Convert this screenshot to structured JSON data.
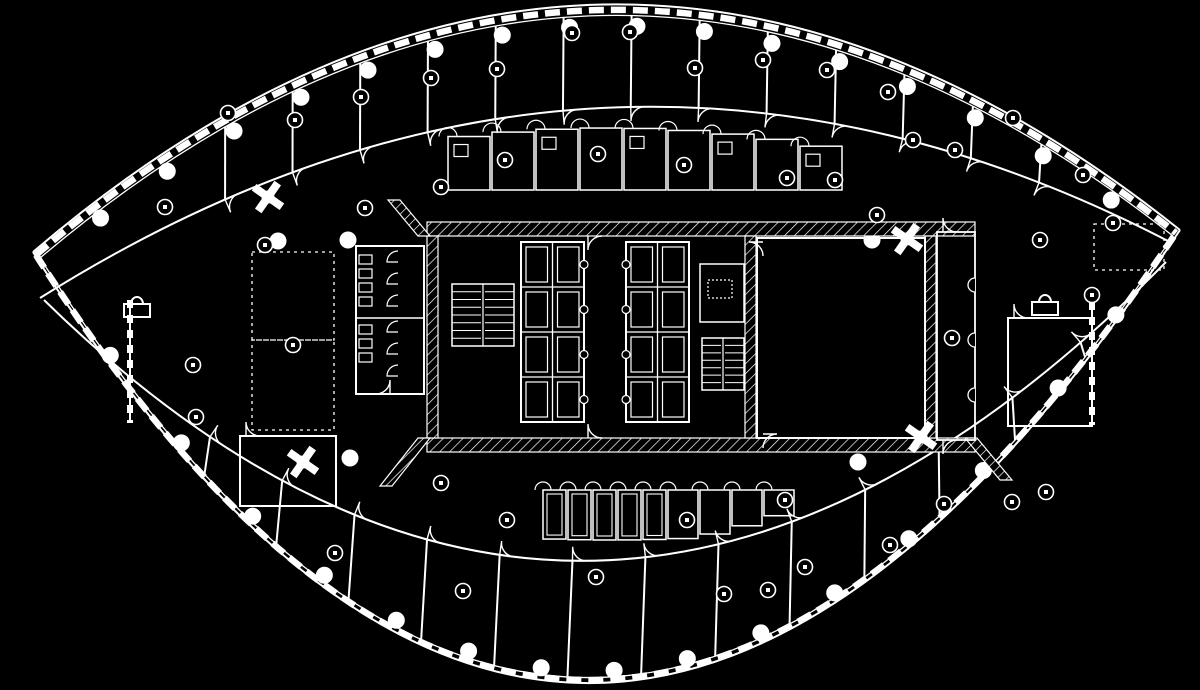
{
  "meta": {
    "title": "floor-plan-drawing",
    "style": "cad-blueprint-inverted",
    "colors": {
      "background": "#000000",
      "line": "#ffffff"
    }
  },
  "plan": {
    "arcs": {
      "outerTop": {
        "p0": [
          33,
          252
        ],
        "c": [
          600,
          -232
        ],
        "p1": [
          1180,
          230
        ],
        "w": 2
      },
      "outerTopIn": {
        "p0": [
          40,
          258
        ],
        "c": [
          600,
          -216
        ],
        "p1": [
          1173,
          236
        ],
        "w": 1.3
      },
      "mullTop": {
        "p0": [
          36,
          255
        ],
        "c": [
          600,
          -224
        ],
        "p1": [
          1176,
          233
        ],
        "w": 6.5,
        "dash": "15 7"
      },
      "outerBot": {
        "p0": [
          33,
          252
        ],
        "c": [
          585,
          1125
        ],
        "p1": [
          1180,
          230
        ],
        "w": 2
      },
      "outerBotIn": {
        "p0": [
          40,
          258
        ],
        "c": [
          585,
          1108
        ],
        "p1": [
          1173,
          236
        ],
        "w": 1.3
      },
      "mullBot": {
        "p0": [
          36,
          255
        ],
        "c": [
          585,
          1116
        ],
        "p1": [
          1176,
          233
        ],
        "w": 6.5,
        "dash": "15 7"
      },
      "innerTop": {
        "p0": [
          40,
          298
        ],
        "c": [
          600,
          -54
        ],
        "p1": [
          1170,
          242
        ],
        "w": 2
      },
      "innerBot": {
        "p0": [
          44,
          300
        ],
        "c": [
          596,
          840
        ],
        "p1": [
          1166,
          262
        ],
        "w": 2
      },
      "colTop": {
        "p0": [
          45,
          262
        ],
        "c": [
          600,
          -200
        ],
        "p1": [
          1168,
          242
        ]
      },
      "colBot": {
        "p0": [
          45,
          262
        ],
        "c": [
          588,
          1090
        ],
        "p1": [
          1168,
          242
        ]
      }
    },
    "partitions": {
      "top": [
        0.165,
        0.225,
        0.285,
        0.345,
        0.405,
        0.465,
        0.525,
        0.585,
        0.645,
        0.705,
        0.765,
        0.825,
        0.885
      ],
      "bottom": [
        0.15,
        0.215,
        0.28,
        0.345,
        0.41,
        0.475,
        0.54,
        0.605,
        0.67,
        0.735,
        0.8,
        0.865,
        0.925
      ],
      "doorRadius": 14
    },
    "columns": {
      "radius": 8,
      "topT": [
        0.05,
        0.11,
        0.17,
        0.23,
        0.29,
        0.35,
        0.41,
        0.47,
        0.53,
        0.59,
        0.65,
        0.71,
        0.77,
        0.83,
        0.89,
        0.95
      ],
      "bottomT": [
        0.06,
        0.125,
        0.19,
        0.255,
        0.32,
        0.385,
        0.45,
        0.515,
        0.58,
        0.645,
        0.71,
        0.775,
        0.84,
        0.905,
        0.955
      ],
      "interior": [
        [
          278,
          241
        ],
        [
          348,
          240
        ],
        [
          872,
          240
        ],
        [
          350,
          458
        ],
        [
          858,
          462
        ]
      ]
    },
    "tags": {
      "radius": 7.5,
      "points": [
        [
          165,
          207
        ],
        [
          228,
          113
        ],
        [
          295,
          120
        ],
        [
          361,
          97
        ],
        [
          431,
          78
        ],
        [
          497,
          69
        ],
        [
          572,
          33
        ],
        [
          630,
          32
        ],
        [
          695,
          68
        ],
        [
          763,
          60
        ],
        [
          827,
          70
        ],
        [
          888,
          92
        ],
        [
          913,
          140
        ],
        [
          955,
          150
        ],
        [
          1013,
          118
        ],
        [
          1083,
          175
        ],
        [
          877,
          215
        ],
        [
          835,
          180
        ],
        [
          684,
          165
        ],
        [
          265,
          245
        ],
        [
          293,
          345
        ],
        [
          193,
          365
        ],
        [
          196,
          417
        ],
        [
          365,
          208
        ],
        [
          441,
          187
        ],
        [
          505,
          160
        ],
        [
          598,
          154
        ],
        [
          787,
          178
        ],
        [
          1040,
          240
        ],
        [
          1092,
          295
        ],
        [
          952,
          338
        ],
        [
          1113,
          223
        ],
        [
          1046,
          492
        ],
        [
          463,
          591
        ],
        [
          596,
          577
        ],
        [
          724,
          594
        ],
        [
          768,
          590
        ],
        [
          805,
          567
        ],
        [
          890,
          545
        ],
        [
          944,
          504
        ],
        [
          1012,
          502
        ],
        [
          335,
          553
        ],
        [
          441,
          483
        ],
        [
          507,
          520
        ],
        [
          687,
          520
        ],
        [
          785,
          500
        ]
      ]
    },
    "core": {
      "hatchBands": [
        [
          427,
          222,
          548,
          14
        ],
        [
          427,
          438,
          548,
          14
        ],
        [
          427,
          236,
          11,
          202
        ],
        [
          745,
          236,
          11,
          202
        ],
        [
          925,
          236,
          11,
          202
        ]
      ],
      "hatchPolys": [
        "M418,236 L430,236 L400,200 L388,200 Z",
        "M418,438 L430,438 L392,486 L380,486 Z",
        "M965,438 L977,438 L1012,480 L1000,480 Z"
      ],
      "banks": [
        {
          "x": 521,
          "y": 242,
          "w": 63,
          "h": 180,
          "rows": 4,
          "cols": 2,
          "doorSide": "right"
        },
        {
          "x": 626,
          "y": 242,
          "w": 63,
          "h": 180,
          "rows": 4,
          "cols": 2,
          "doorSide": "left"
        }
      ],
      "stairs": [
        {
          "x": 452,
          "y": 284,
          "w": 62,
          "h": 62,
          "treads": 8
        },
        {
          "x": 702,
          "y": 338,
          "w": 42,
          "h": 52,
          "treads": 7
        }
      ],
      "washroom": {
        "x": 356,
        "y": 246,
        "w": 68,
        "h": 148,
        "midY": 318,
        "fixturesY": [
          255,
          269,
          283,
          297,
          325,
          339,
          353
        ],
        "stallsY": [
          262,
          284,
          306,
          332,
          354,
          376
        ]
      },
      "mechRoom": {
        "x": 700,
        "y": 264,
        "w": 44,
        "h": 58,
        "innerX": 708,
        "innerY": 280,
        "innerW": 24,
        "innerH": 18
      },
      "bigRoom": {
        "x": 757,
        "y": 238,
        "w": 168,
        "h": 200
      },
      "rightLobby": {
        "x": 937,
        "y": 232,
        "w": 38,
        "h": 208,
        "bumpsY": [
          285,
          340,
          395
        ]
      },
      "lobbyX1": 584,
      "lobbyX2": 626
    },
    "serviceRooms": {
      "top": {
        "xs": [
          448,
          492,
          536,
          580,
          624,
          668,
          712,
          756,
          800
        ],
        "w": 42,
        "bottom": 190
      },
      "bottom": {
        "xs": [
          543,
          568,
          593,
          618,
          643,
          668,
          700,
          732,
          764
        ],
        "w": [
          23,
          23,
          23,
          23,
          23,
          30,
          30,
          30,
          30
        ],
        "top": 490
      }
    },
    "extras": {
      "dashedRooms": [
        [
          252,
          252,
          82,
          88
        ],
        [
          252,
          340,
          82,
          90
        ],
        [
          1094,
          224,
          70,
          46
        ]
      ],
      "solidRooms": [
        [
          240,
          436,
          96,
          70
        ],
        [
          1008,
          318,
          84,
          108
        ]
      ],
      "stubWalls": [
        [
          130,
          300,
          130,
          423
        ],
        [
          1092,
          302,
          1092,
          425
        ]
      ],
      "fixtureIcons": [
        [
          137,
          308
        ],
        [
          1045,
          306
        ]
      ],
      "crossBlobs": [
        [
          268,
          197
        ],
        [
          303,
          462
        ],
        [
          907,
          239
        ],
        [
          921,
          437
        ]
      ]
    },
    "icon_legend": {
      "column-marker": "filled-circle",
      "room-tag": "small-circle-with-mark",
      "door-arc": "quarter-circle-swing",
      "stair": "parallel-tread-lines",
      "elevator-bank": "grid-of-cars",
      "hatched-wall": "diagonal-hatch-poche"
    }
  }
}
